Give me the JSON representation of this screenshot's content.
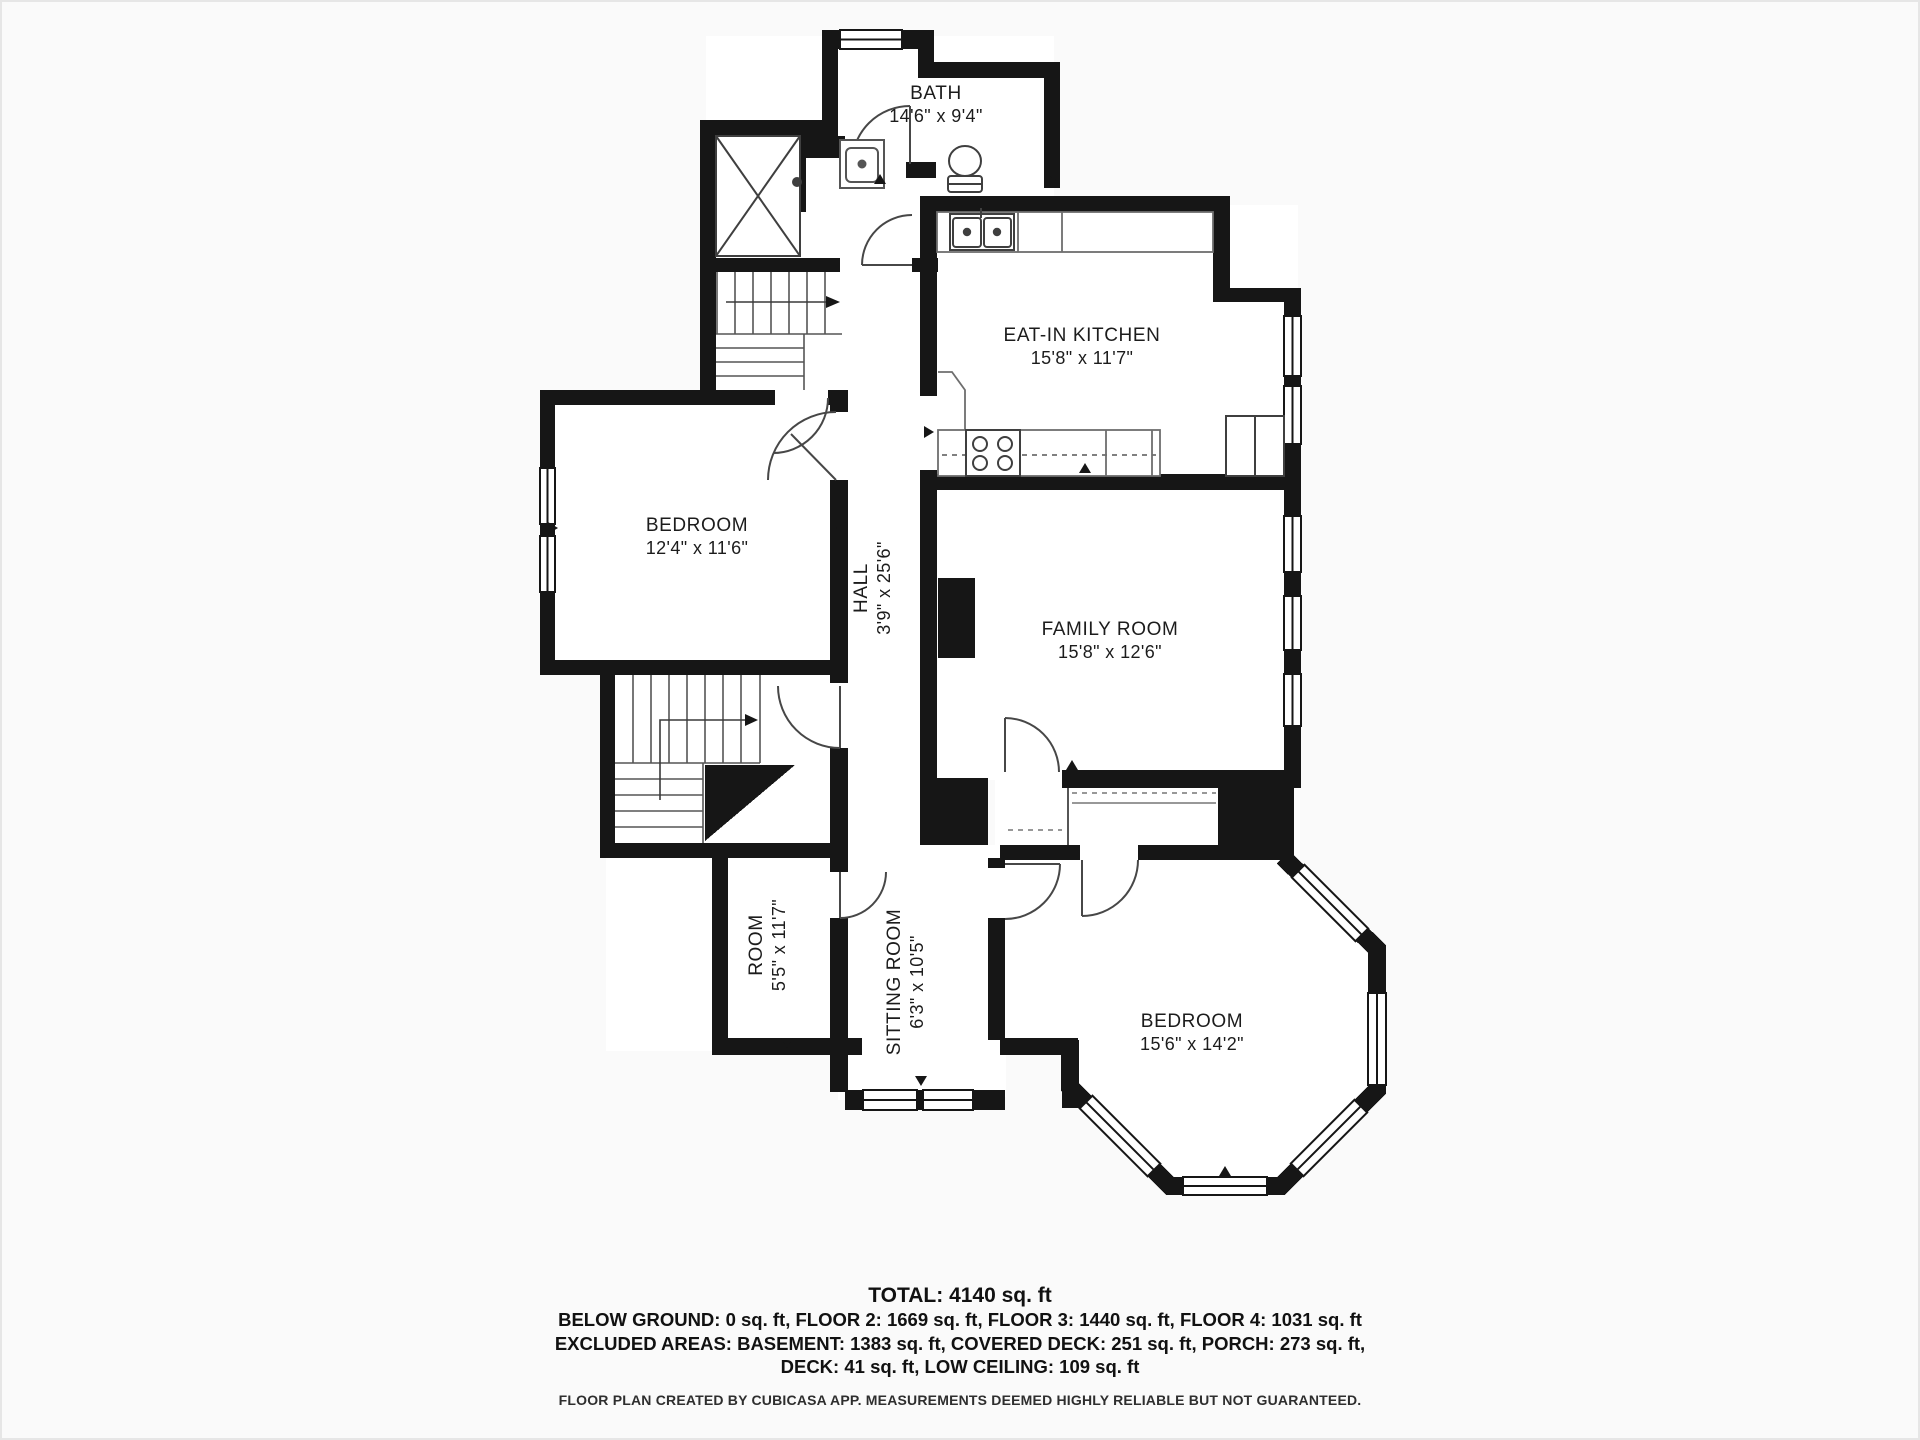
{
  "title": "Floor plan",
  "colors": {
    "wall": "#161616",
    "background": "#fafafa",
    "floor": "#ffffff",
    "line": "#4d4d4d"
  },
  "rooms": {
    "bath": {
      "label": "BATH",
      "dims": "14'6\" x 9'4\""
    },
    "kitchen": {
      "label": "EAT-IN KITCHEN",
      "dims": "15'8\" x 11'7\""
    },
    "bedroom_left": {
      "label": "BEDROOM",
      "dims": "12'4\" x 11'6\""
    },
    "hall": {
      "label": "HALL",
      "dims": "3'9\" x 25'6\""
    },
    "family_room": {
      "label": "FAMILY ROOM",
      "dims": "15'8\" x 12'6\""
    },
    "room_small": {
      "label": "ROOM",
      "dims": "5'5\" x 11'7\""
    },
    "sitting_room": {
      "label": "SITTING ROOM",
      "dims": "6'3\" x 10'5\""
    },
    "bedroom_bottom": {
      "label": "BEDROOM",
      "dims": "15'6\" x 14'2\""
    }
  },
  "summary": {
    "total": "TOTAL: 4140 sq. ft",
    "line1": "BELOW GROUND: 0 sq. ft, FLOOR 2: 1669 sq. ft, FLOOR 3: 1440 sq. ft, FLOOR 4: 1031 sq. ft",
    "line2": "EXCLUDED AREAS: BASEMENT: 1383 sq. ft, COVERED DECK: 251 sq. ft, PORCH: 273 sq. ft,",
    "line3": "DECK: 41 sq. ft, LOW CEILING: 109 sq. ft"
  },
  "footer": "FLOOR PLAN CREATED BY CUBICASA APP. MEASUREMENTS DEEMED HIGHLY RELIABLE BUT NOT GUARANTEED."
}
